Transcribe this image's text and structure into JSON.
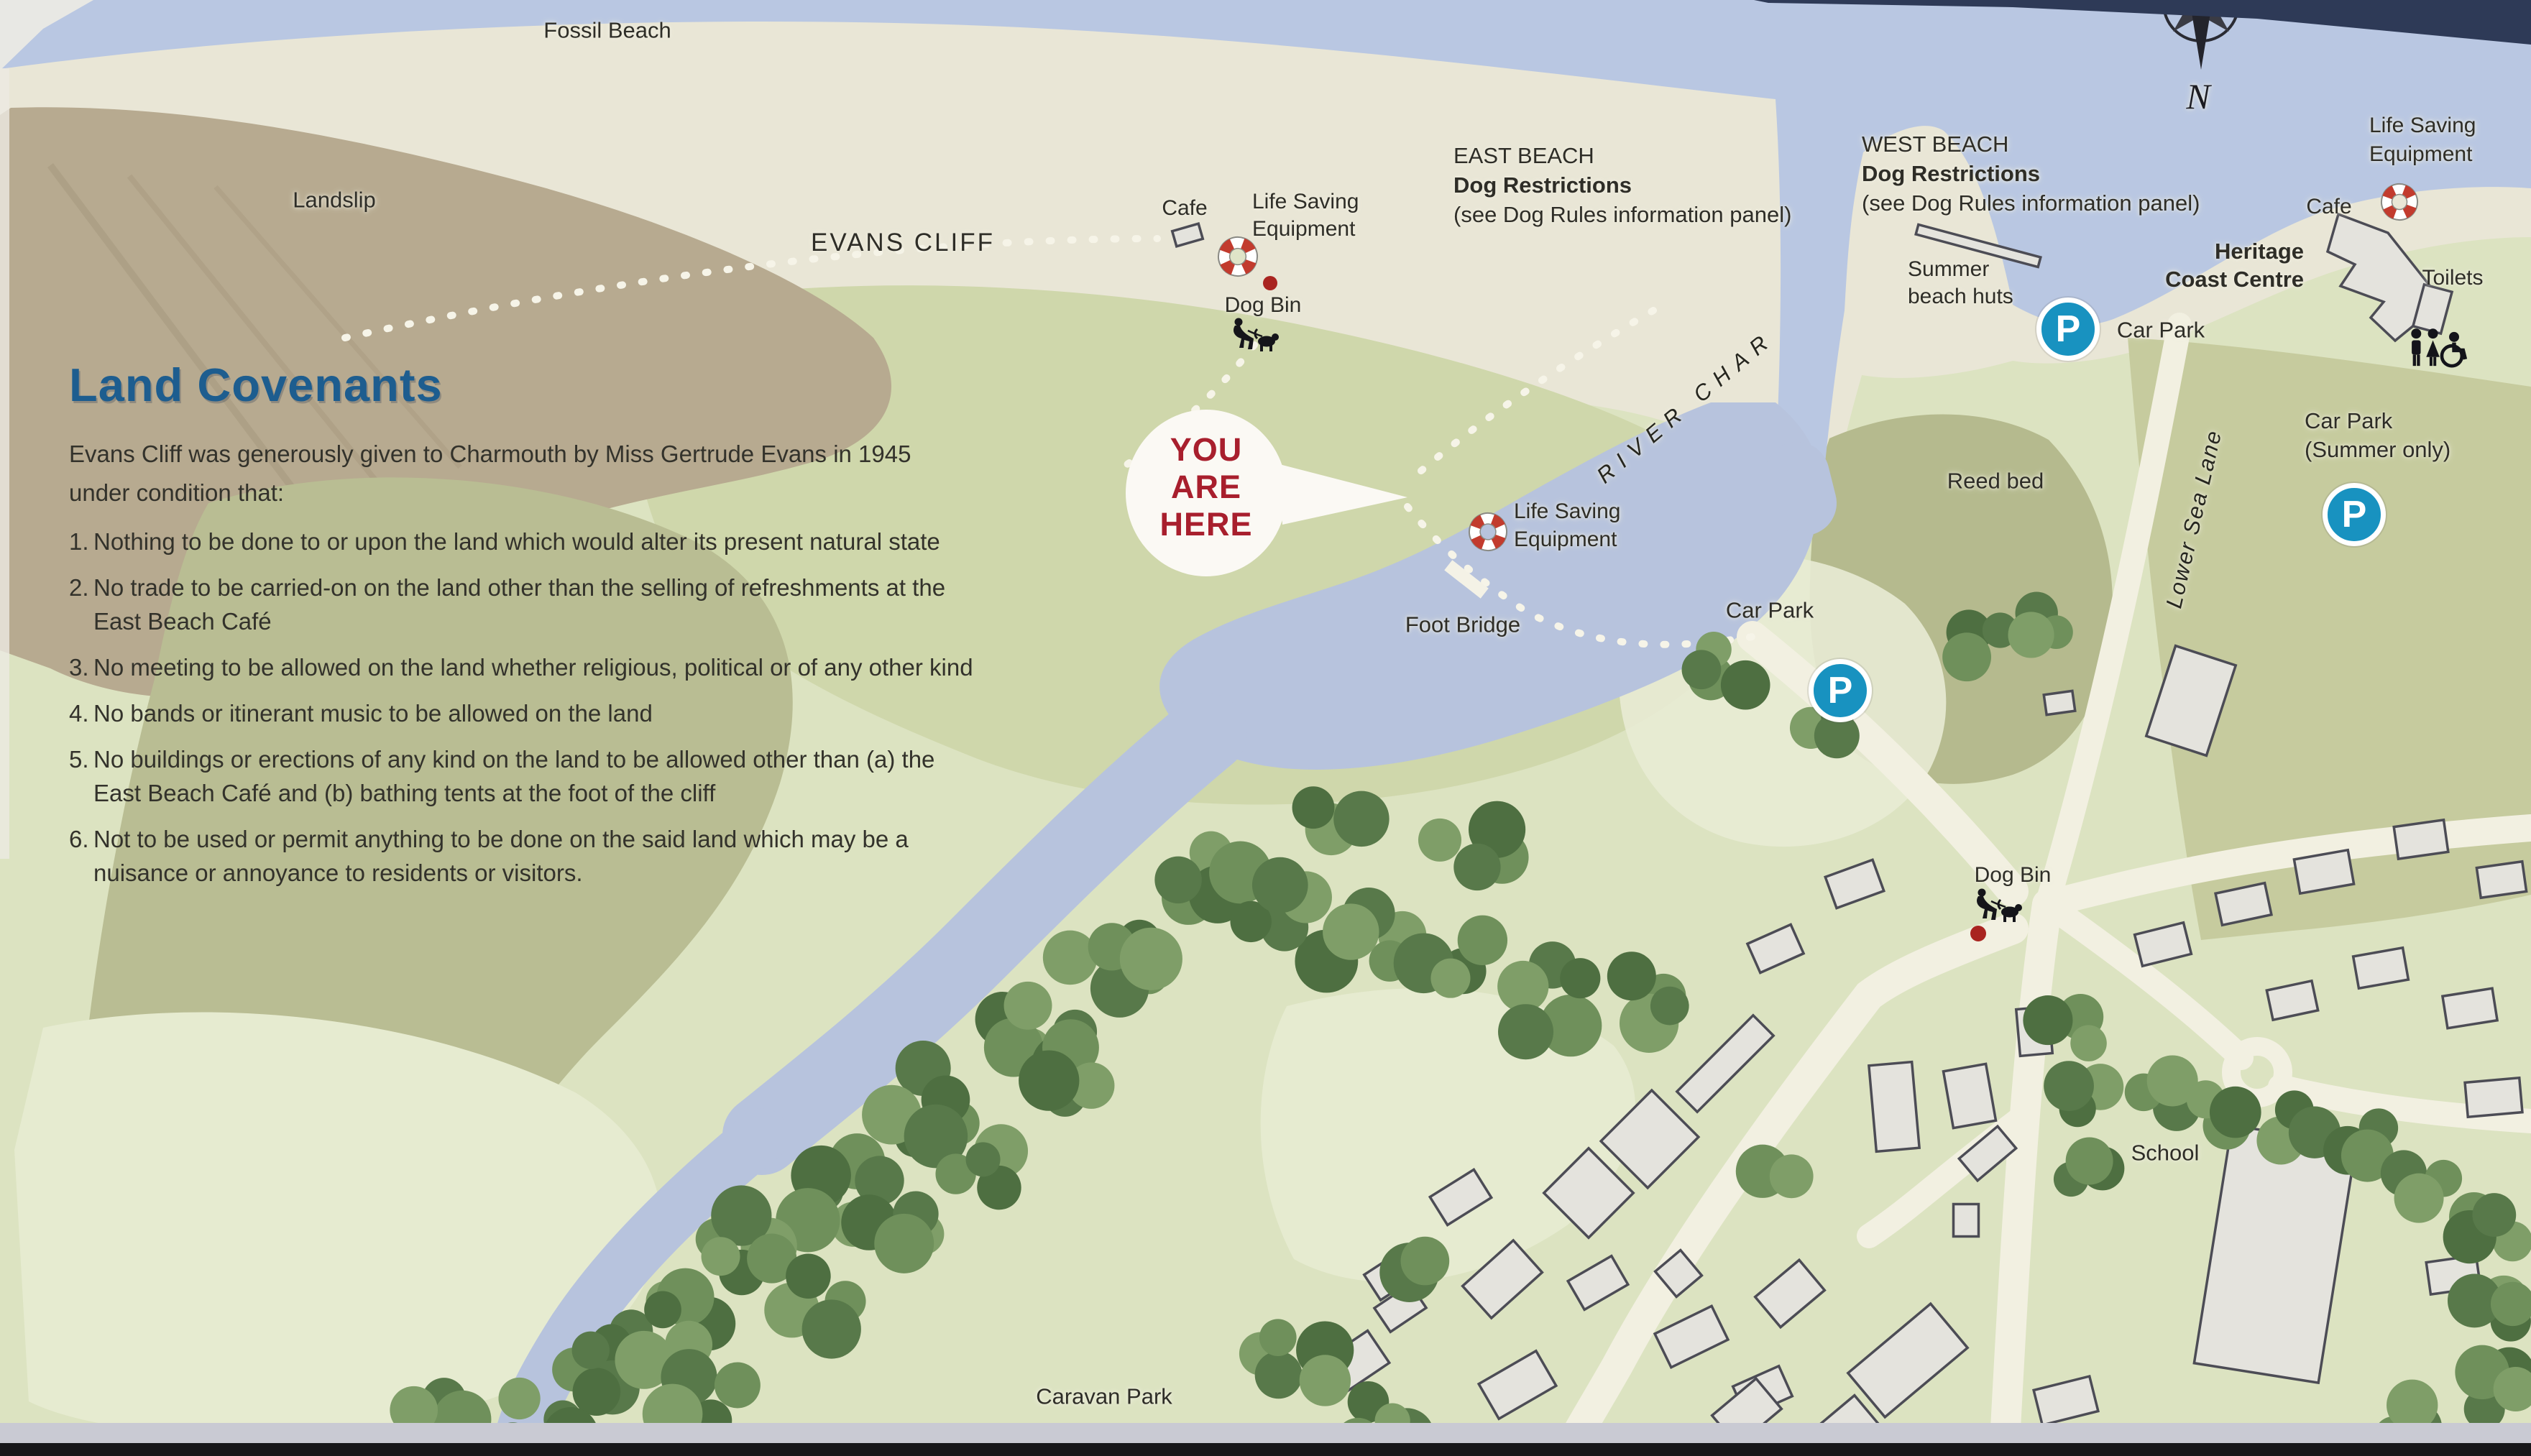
{
  "covenants": {
    "title": "Land Covenants",
    "intro_line1": "Evans Cliff was generously given to Charmouth by Miss Gertrude Evans in 1945",
    "intro_line2": "under condition that:",
    "items": [
      {
        "num": "1.",
        "lines": [
          "Nothing to be done to or upon the land which would alter its present natural state"
        ]
      },
      {
        "num": "2.",
        "lines": [
          "No trade to be carried-on on the land other than the selling of refreshments at the",
          "East Beach Café"
        ]
      },
      {
        "num": "3.",
        "lines": [
          "No meeting to be allowed on the land whether religious, political or of any other kind"
        ]
      },
      {
        "num": "4.",
        "lines": [
          "No bands or itinerant music to be allowed on the land"
        ]
      },
      {
        "num": "5.",
        "lines": [
          "No buildings or erections of any kind on the land to be allowed other than (a) the",
          "East Beach Café and (b) bathing tents at the foot of the cliff"
        ]
      },
      {
        "num": "6.",
        "lines": [
          "Not to be used or permit anything to be done on the said land which may be a",
          "nuisance or annoyance to residents or visitors."
        ]
      }
    ]
  },
  "labels": {
    "fossil_beach": "Fossil Beach",
    "landslip": "Landslip",
    "evans_cliff": "EVANS CLIFF",
    "east_beach_1": "EAST BEACH",
    "east_beach_2": "Dog Restrictions",
    "east_beach_3": "(see Dog Rules information panel)",
    "west_beach_1": "WEST BEACH",
    "west_beach_2": "Dog Restrictions",
    "west_beach_3": "(see Dog Rules information panel)",
    "cafe": "Cafe",
    "life_saving_1": "Life Saving",
    "life_saving_2": "Equipment",
    "dog_bin": "Dog Bin",
    "you_are_here_1": "YOU",
    "you_are_here_2": "ARE",
    "you_are_here_3": "HERE",
    "river_char": "RIVER CHAR",
    "foot_bridge": "Foot Bridge",
    "car_park": "Car Park",
    "car_park_summer_1": "Car Park",
    "car_park_summer_2": "(Summer only)",
    "reed_bed": "Reed bed",
    "summer_huts_1": "Summer",
    "summer_huts_2": "beach huts",
    "heritage_1": "Heritage",
    "heritage_2": "Coast Centre",
    "toilets": "Toilets",
    "lower_sea_lane": "Lower Sea Lane",
    "school": "School",
    "caravan_park": "Caravan Park",
    "compass_n": "N",
    "parking_p": "P"
  },
  "colors": {
    "title_blue": "#1d5d8f",
    "you_are_here_red": "#a81f2d",
    "parking_blue": "#1892c0",
    "lifebuoy_red": "#c23b2e",
    "sea": "#b9c7e2",
    "river": "#b7c3dd",
    "beach": "#e9e6d6",
    "land_green": "#dce3c1",
    "tree_green": "#58794a"
  }
}
